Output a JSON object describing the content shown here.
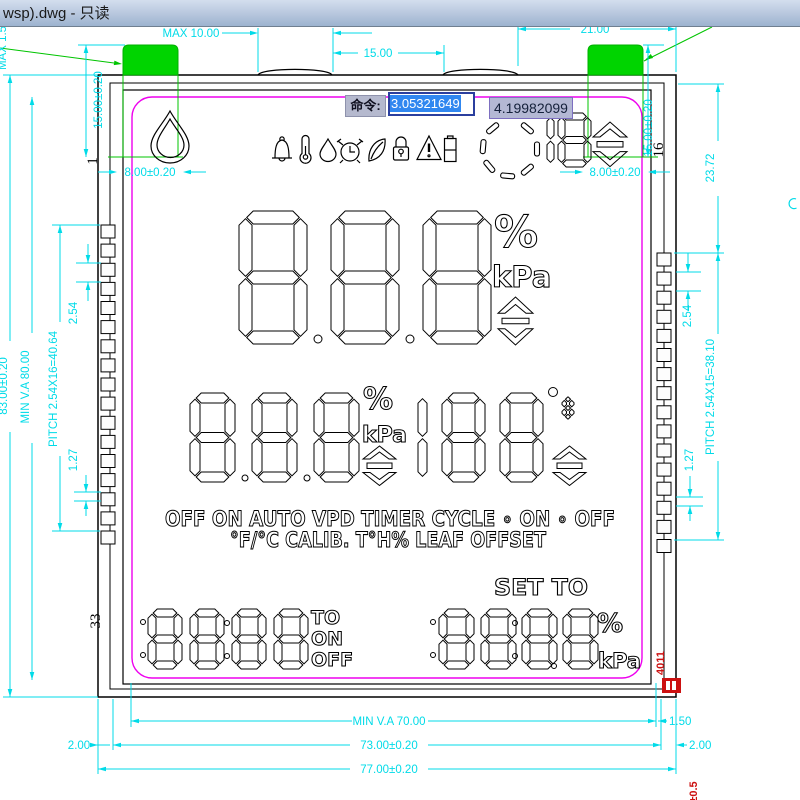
{
  "window": {
    "title": "wsp).dwg - 只读"
  },
  "command_bar": {
    "label": "命令:",
    "value": "3.05321649",
    "tooltip": "4.19982099"
  },
  "dims": {
    "max10": "MAX  10.00",
    "d15": "15.00",
    "d21": "21.00",
    "tab_l": "8.00±0.20",
    "tab_r": "8.00±0.20",
    "v15_l": "15.00±0.20",
    "v15_r": "15.00±0.20",
    "max_side": "MAX 1.5",
    "h83": "83.00±0.20",
    "minva80": "MIN  V.A  80.00",
    "pitch_l": "PITCH  2.54X16=40.64",
    "p254_l": "2.54",
    "p127_l": "1.27",
    "d2372": "23.72",
    "p254_r": "2.54",
    "pitch_r": "PITCH  2.54X15=38.10",
    "p127_r": "1.27",
    "minva70": "MIN  V.A  70.00",
    "d150": "1.50",
    "d73": "73.00±0.20",
    "d200l": "2.00",
    "d200r": "2.00",
    "d77": "77.00±0.20"
  },
  "pin_labels": {
    "left_first": "1",
    "left_last": "33",
    "right_first": "16"
  },
  "lcd": {
    "status_line1": "OFF ON AUTO VPD TIMER CYCLE ∘ ON ∘ OFF",
    "status_line2": "°F/°C CALIB. T°H% LEAF OFFSET",
    "set_to": "SET TO",
    "timer_labels": [
      "TO",
      "ON",
      "OFF"
    ],
    "units_top": [
      "%",
      "kPa"
    ],
    "units_mid": [
      "%",
      "kPa"
    ],
    "units_bottom": [
      "%",
      "kPa"
    ],
    "displays": {
      "main": "888",
      "mid_left": "888",
      "mid_right": "188",
      "fan": "18",
      "fc": "8",
      "bottom_left": "8888",
      "bottom_right": "8888"
    },
    "icons": [
      "water-drop",
      "bell",
      "thermometer",
      "droplet",
      "alarm-clock",
      "leaf",
      "lock",
      "warning-triangle",
      "battery",
      "fan-rotation"
    ]
  },
  "annotations": {
    "red_code": "4011",
    "red_tol": "±0.5"
  },
  "colors": {
    "dimension": "#00dbe8",
    "green": "#00d400",
    "magenta": "#ee00ee",
    "red": "#cc1111",
    "selection": "#3087f0"
  }
}
